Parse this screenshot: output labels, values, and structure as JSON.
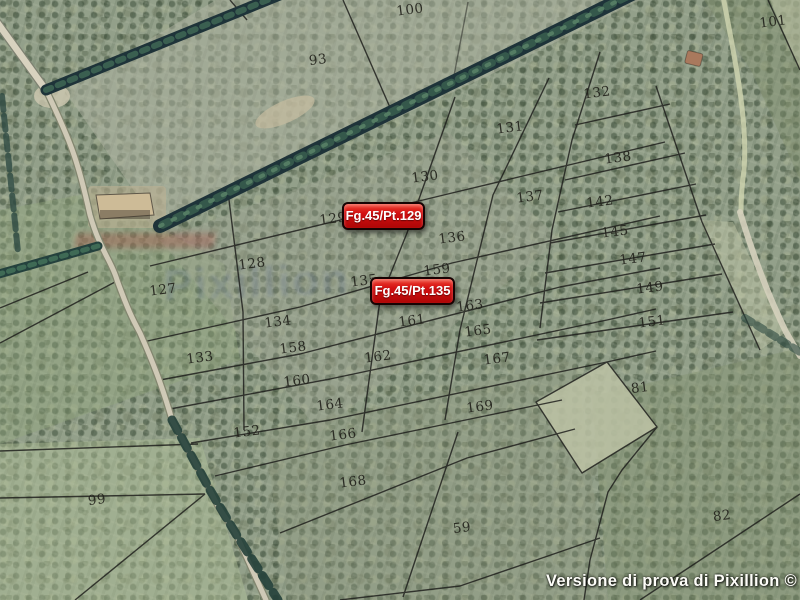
{
  "map": {
    "kind": "cadastral parcel overlay on aerial orthophoto",
    "trial_watermark": "Versione di prova di Pixillion ©",
    "ghost_watermark": "Pixillion",
    "markers": [
      {
        "id": "parcel-marker-129",
        "text": "Fg.45/Pt.129",
        "x": 342,
        "y": 202,
        "w": 83,
        "h": 28
      },
      {
        "id": "parcel-marker-135",
        "text": "Fg.45/Pt.135",
        "x": 370,
        "y": 277,
        "w": 85,
        "h": 28
      }
    ],
    "parcel_numbers": [
      {
        "num": "93",
        "x": 318,
        "y": 60
      },
      {
        "num": "100",
        "x": 410,
        "y": 10
      },
      {
        "num": "101",
        "x": 773,
        "y": 22
      },
      {
        "num": "132",
        "x": 597,
        "y": 93
      },
      {
        "num": "131",
        "x": 510,
        "y": 128
      },
      {
        "num": "130",
        "x": 425,
        "y": 177
      },
      {
        "num": "138",
        "x": 618,
        "y": 158
      },
      {
        "num": "137",
        "x": 530,
        "y": 197
      },
      {
        "num": "142",
        "x": 600,
        "y": 202
      },
      {
        "num": "145",
        "x": 615,
        "y": 232
      },
      {
        "num": "147",
        "x": 633,
        "y": 259
      },
      {
        "num": "149",
        "x": 650,
        "y": 288
      },
      {
        "num": "151",
        "x": 652,
        "y": 322
      },
      {
        "num": "129",
        "x": 333,
        "y": 219
      },
      {
        "num": "136",
        "x": 452,
        "y": 238
      },
      {
        "num": "159",
        "x": 437,
        "y": 270
      },
      {
        "num": "135",
        "x": 364,
        "y": 281
      },
      {
        "num": "127",
        "x": 163,
        "y": 290
      },
      {
        "num": "128",
        "x": 252,
        "y": 264
      },
      {
        "num": "134",
        "x": 278,
        "y": 322
      },
      {
        "num": "133",
        "x": 200,
        "y": 358
      },
      {
        "num": "158",
        "x": 293,
        "y": 348
      },
      {
        "num": "161",
        "x": 412,
        "y": 321
      },
      {
        "num": "163",
        "x": 470,
        "y": 306
      },
      {
        "num": "162",
        "x": 378,
        "y": 357
      },
      {
        "num": "165",
        "x": 478,
        "y": 331
      },
      {
        "num": "167",
        "x": 497,
        "y": 359
      },
      {
        "num": "160",
        "x": 297,
        "y": 381
      },
      {
        "num": "164",
        "x": 330,
        "y": 405
      },
      {
        "num": "169",
        "x": 480,
        "y": 407
      },
      {
        "num": "152",
        "x": 247,
        "y": 432
      },
      {
        "num": "166",
        "x": 343,
        "y": 435
      },
      {
        "num": "168",
        "x": 353,
        "y": 482
      },
      {
        "num": "59",
        "x": 462,
        "y": 528
      },
      {
        "num": "99",
        "x": 97,
        "y": 500
      },
      {
        "num": "81",
        "x": 640,
        "y": 388
      },
      {
        "num": "82",
        "x": 722,
        "y": 516
      }
    ],
    "colors": {
      "field_base": "#93a08a",
      "tree_band": "#203339",
      "road": "#d6d0bc",
      "parcel_line": "#1c1c1a",
      "marker_bg": "#cf0f0f",
      "marker_border": "#190505",
      "marker_text": "#ffffff",
      "number_text": "#26261f"
    }
  }
}
